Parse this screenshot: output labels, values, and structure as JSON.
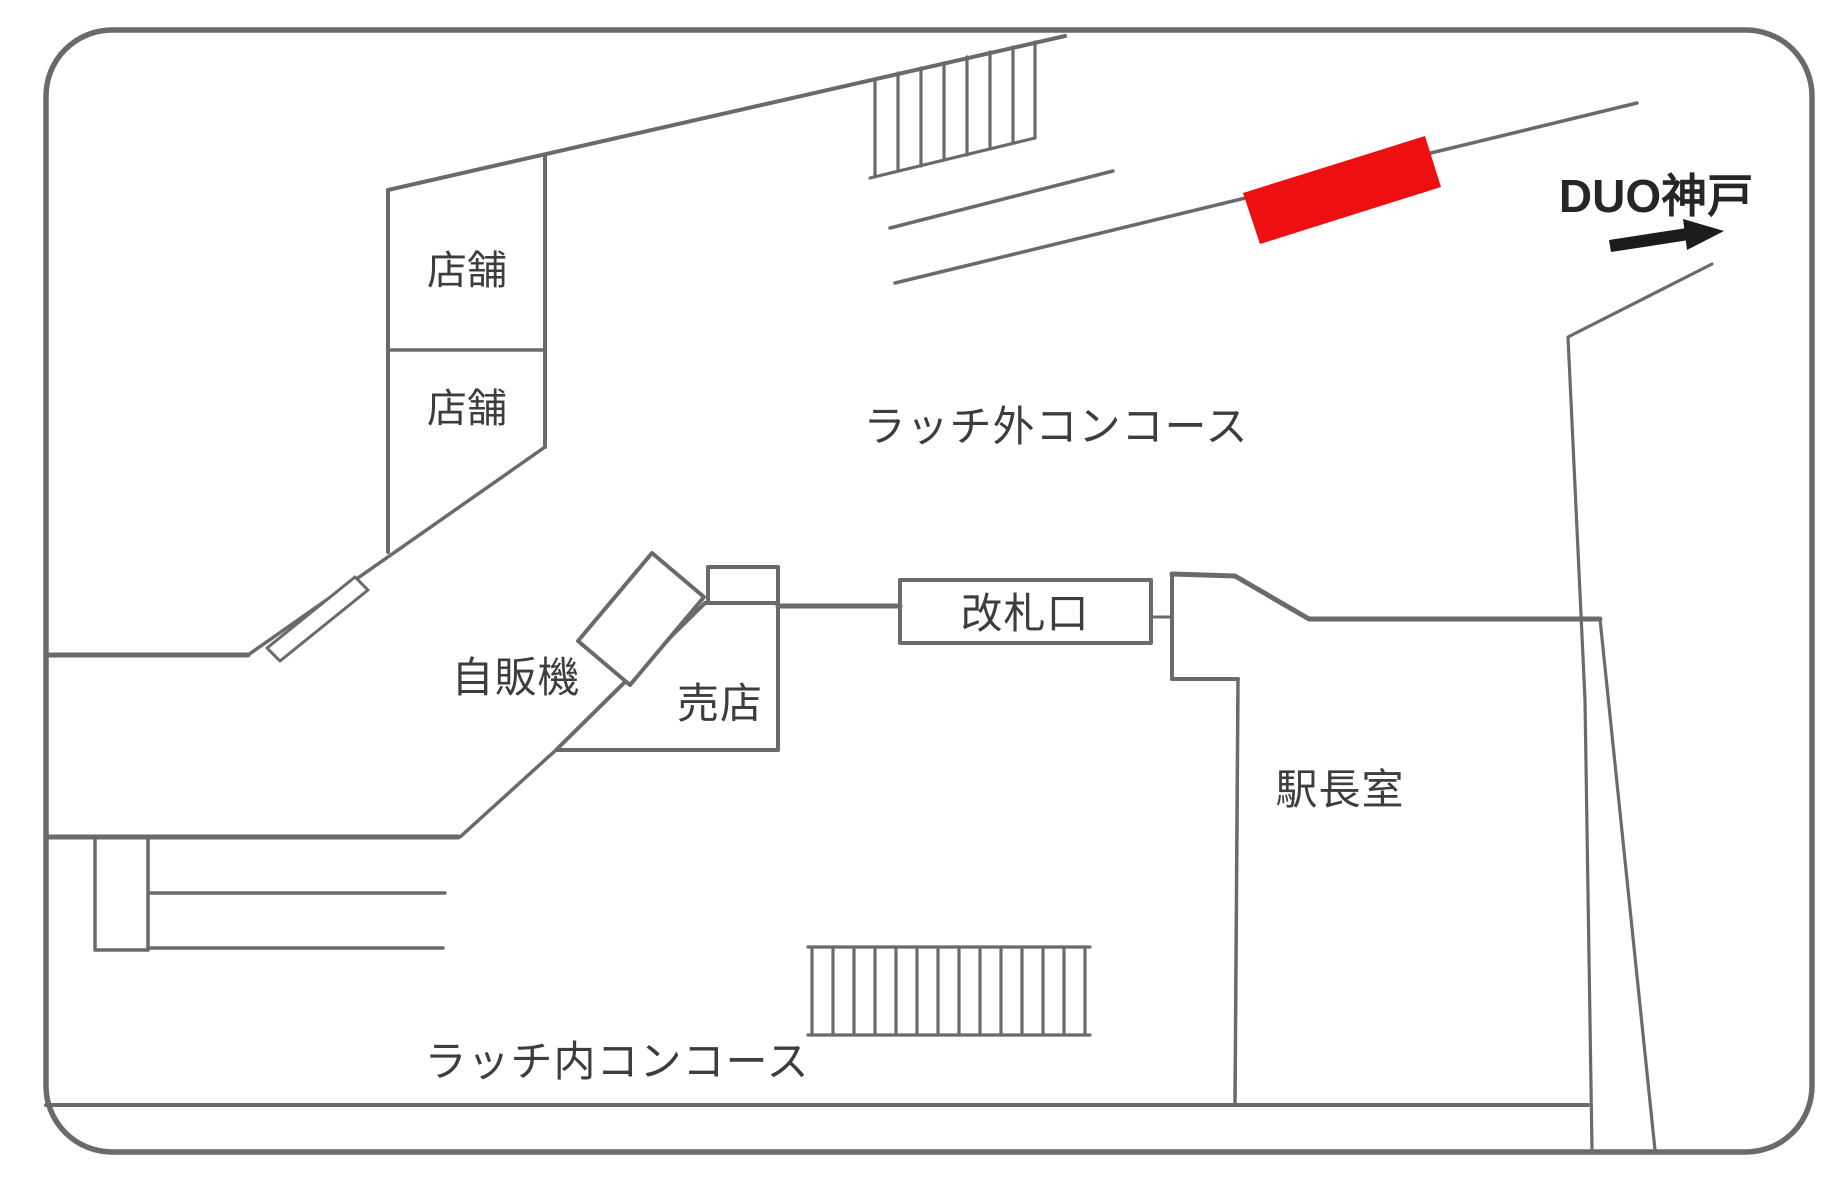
{
  "colors": {
    "wall_line": "#6a6a6a",
    "thin_line": "#707070",
    "label_text": "#3d3d3d",
    "highlight_red": "#ee1010",
    "arrow_black": "#1b1b1b",
    "background": "#ffffff"
  },
  "map": {
    "title_semantic": "station-concourse-floor-plan",
    "areas": {
      "shop_upper": "店舗",
      "shop_lower": "店舗",
      "outside_concourse": "ラッチ外コンコース",
      "vending_machine": "自販機",
      "kiosk": "売店",
      "ticket_gate": "改札口",
      "station_master_office": "駅長室",
      "inside_concourse": "ラッチ内コンコース"
    },
    "exit": {
      "label": "DUO神戸",
      "arrow_icon": "right-arrow"
    },
    "highlight_marker": "ad-position-red-box"
  }
}
